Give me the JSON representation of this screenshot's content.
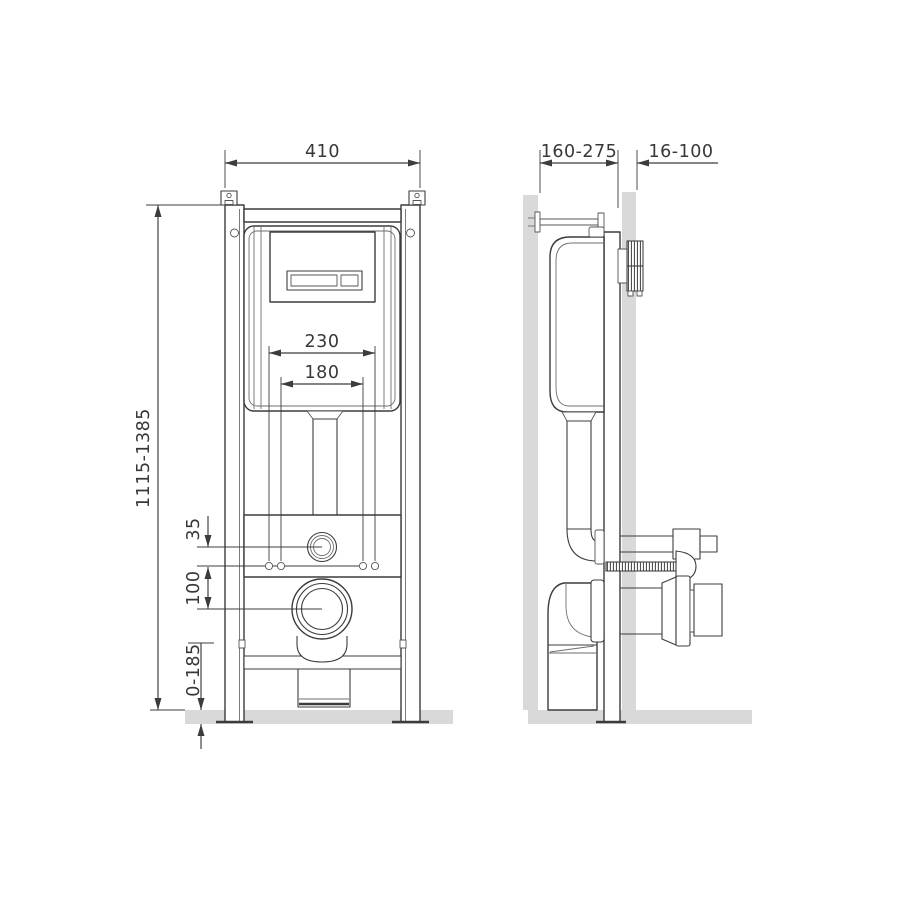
{
  "colors": {
    "line": "#3c3c3c",
    "line_light": "#6e6e6e",
    "surface_gray": "#d9d9d9",
    "background": "#ffffff"
  },
  "dimensions": {
    "front": {
      "frame_width": "410",
      "frame_height_range": "1115-1385",
      "fixing_spacing_outer": "230",
      "fixing_spacing_inner": "180",
      "flushpipe_to_fixings": "35",
      "fixings_to_outlet": "100",
      "foot_adjustment_range": "0-185"
    },
    "side": {
      "installation_depth_range": "160-275",
      "wall_finish_offset_range": "16-100"
    }
  }
}
